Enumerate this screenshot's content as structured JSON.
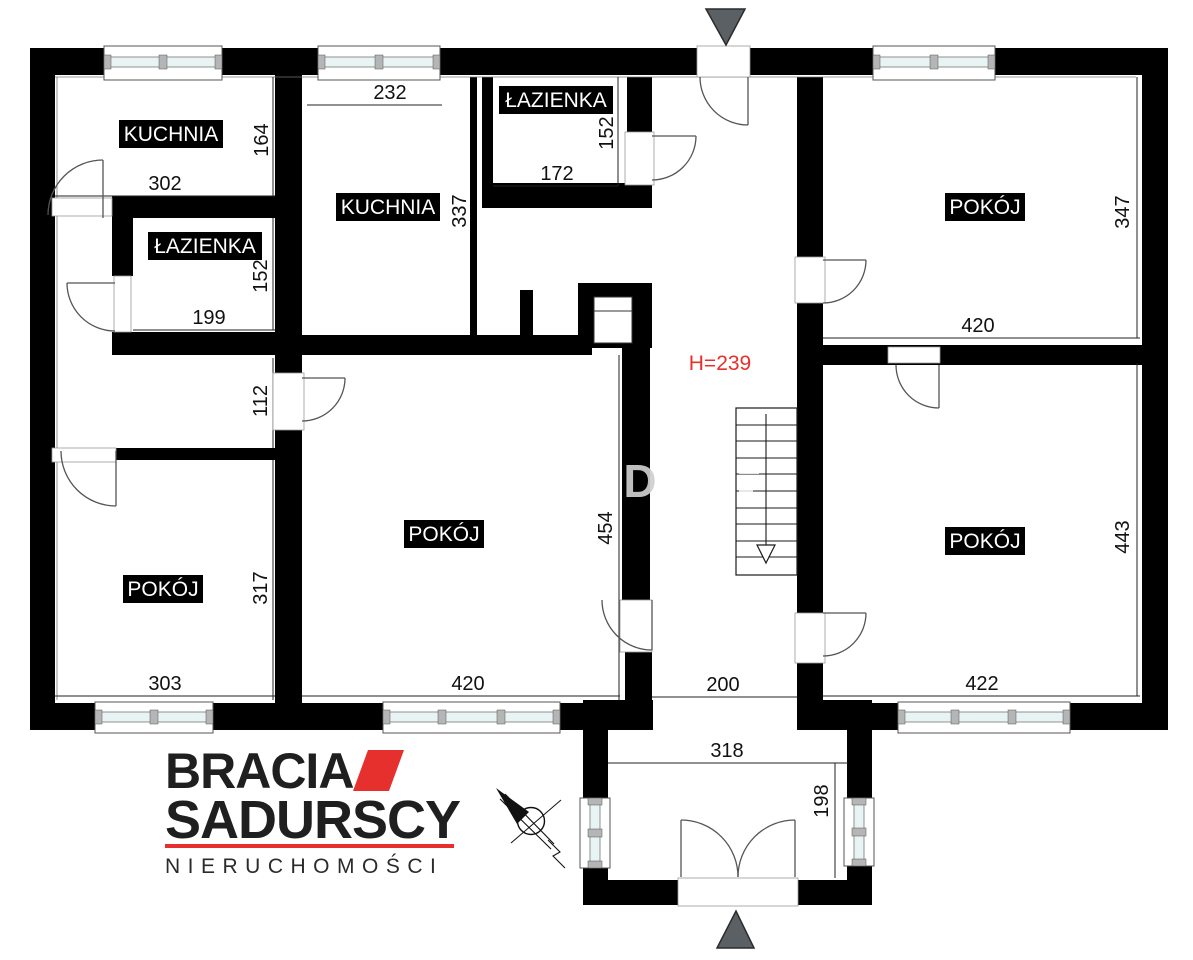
{
  "plan": {
    "rooms": [
      {
        "key": "kuchnia-top-left",
        "label": "KUCHNIA",
        "width_cm": "302",
        "height_cm": "164"
      },
      {
        "key": "lazienka-left",
        "label": "ŁAZIENKA",
        "width_cm": "199",
        "height_cm": "152"
      },
      {
        "key": "kuchnia-middle",
        "label": "KUCHNIA",
        "width_cm": "232",
        "height_cm": "337"
      },
      {
        "key": "lazienka-top",
        "label": "ŁAZIENKA",
        "width_cm": "172",
        "height_cm": "152"
      },
      {
        "key": "pokoj-top-right",
        "label": "POKÓJ",
        "width_cm": "420",
        "height_cm": "347"
      },
      {
        "key": "pokoj-middle",
        "label": "POKÓJ",
        "width_cm": "420",
        "height_cm": "454"
      },
      {
        "key": "pokoj-bottom-left",
        "label": "POKÓJ",
        "width_cm": "303",
        "height_cm": "317"
      },
      {
        "key": "pokoj-bottom-right",
        "label": "POKÓJ",
        "width_cm": "422",
        "height_cm": "443"
      }
    ],
    "corridor_width_cm": "112",
    "hall_width_cm": "200",
    "porch_width_cm": "318",
    "porch_depth_cm": "198",
    "ceiling_height_label": "H=239",
    "watermark_fragment": "D"
  },
  "logo": {
    "line1": "BRACIA",
    "line2": "SADURSCY",
    "tagline": "NIERUCHOMOŚCI"
  },
  "colors": {
    "wall": "#000000",
    "accent_red": "#e5302e",
    "annotation_red": "#e8302a",
    "marker_gray": "#5a6064",
    "window_glass": "#e8f3f3"
  }
}
